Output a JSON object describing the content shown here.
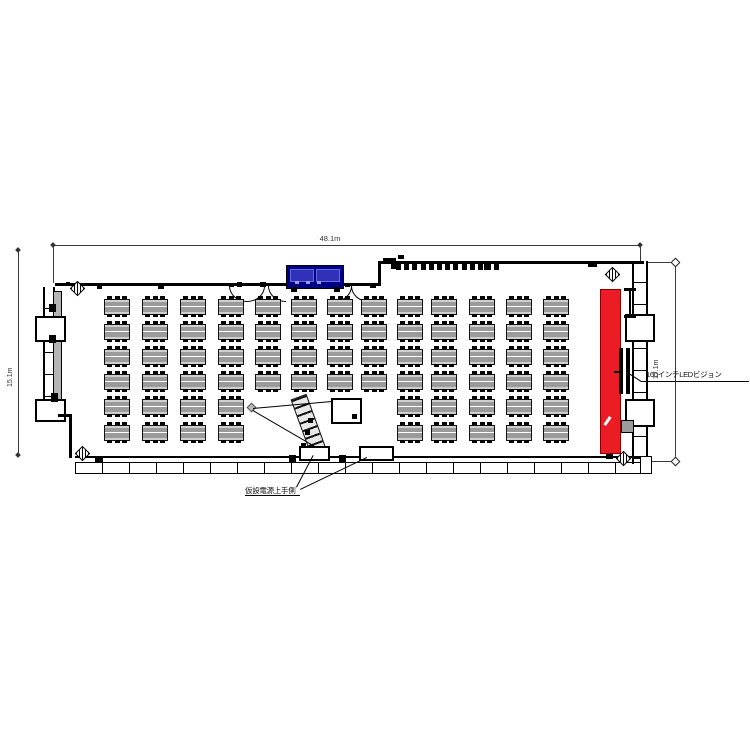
{
  "drawing": {
    "type": "event-hall-floor-plan",
    "dimensions": {
      "top_width": "48.1m",
      "left_height": "15.1m",
      "right_height": "17.1m"
    },
    "annotations": {
      "led_vision_label": "160インチLEDビジョン",
      "bottom_note_label": "仮設電源上手側"
    },
    "colors": {
      "led_screen_red": "#ec1c24",
      "stage_blue": "#000085",
      "stage_blue_light": "#3030b8",
      "table_fill": "#cfcfcf",
      "table_stripe": "#9a9a9a",
      "wall_black": "#000000",
      "dim_gray": "#3a3a3a",
      "panel_gray": "#b5b5b5"
    },
    "floorplan": {
      "table_grid": {
        "col_x": [
          104,
          142,
          180,
          218,
          255,
          291,
          327,
          361,
          397,
          431,
          469,
          506,
          543
        ],
        "row_y": [
          299,
          324,
          349,
          374,
          399,
          425
        ],
        "table_w": 24,
        "table_h": 14,
        "nub_offsets": [
          2,
          10,
          17
        ],
        "missing_cells": [
          [
            4,
            4
          ],
          [
            5,
            4
          ],
          [
            6,
            4
          ],
          [
            7,
            4
          ],
          [
            4,
            5
          ],
          [
            5,
            5
          ],
          [
            6,
            5
          ],
          [
            7,
            5
          ]
        ],
        "table_count": 70
      },
      "top_chair_row": {
        "x_start": 396,
        "count": 13,
        "spacing": 8.2,
        "y": 264
      },
      "bottom_panel_wall": {
        "x": 75,
        "y": 456,
        "width": 572,
        "height": 15,
        "panel_spacing": 27
      }
    }
  }
}
